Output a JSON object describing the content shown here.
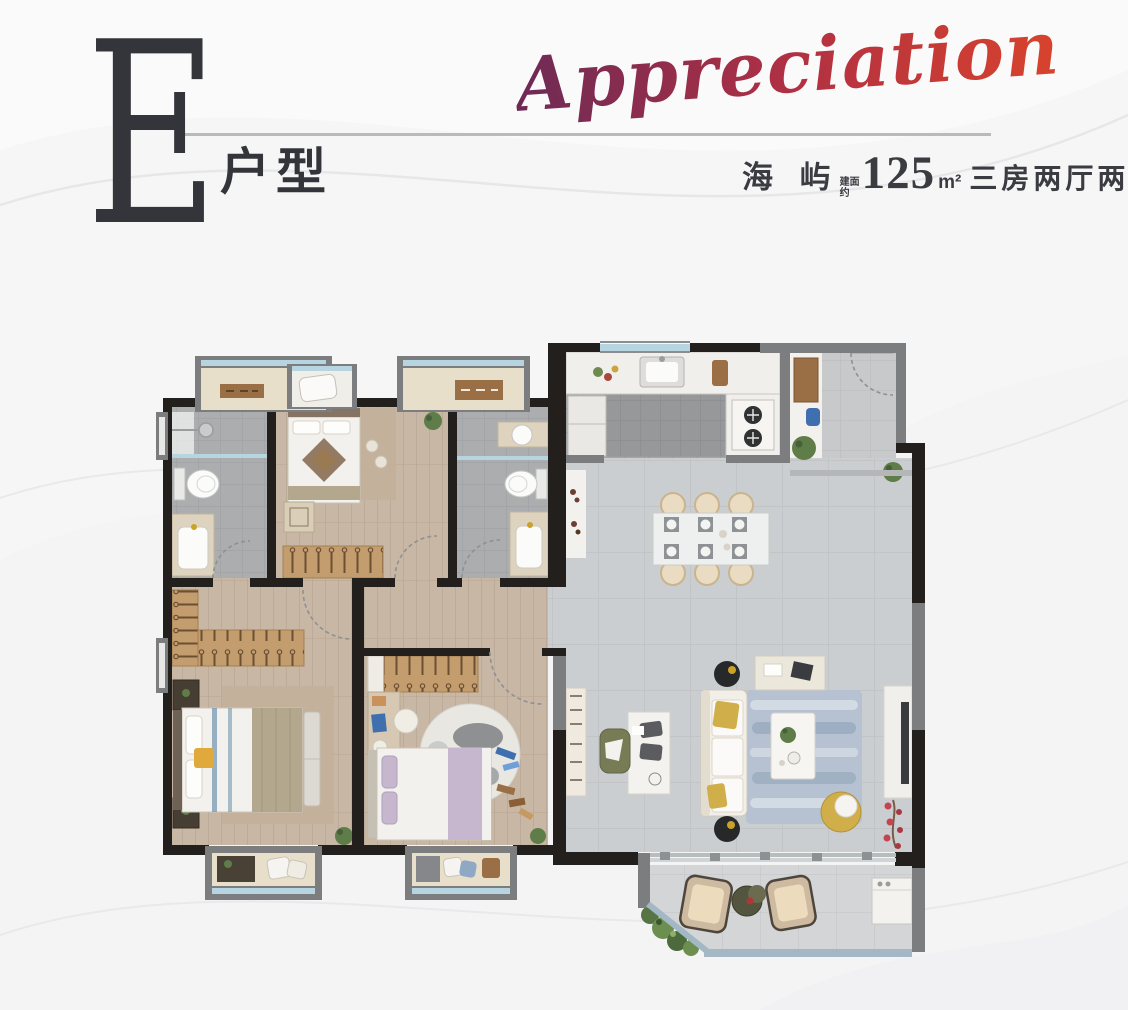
{
  "header": {
    "unit_letter": "E",
    "unit_label": "户型",
    "script_word": "Appreciation",
    "project_name": "海 屿",
    "area_prefix_line1": "建面",
    "area_prefix_line2": "约",
    "area_value": "125",
    "area_unit": "m²",
    "layout_summary": "三房两厅两卫",
    "text_color": "#34353b",
    "divider_color": "#b9babc"
  },
  "floor_plan": {
    "type": "residential-unit-plan",
    "palette": {
      "grad1": "#6d2a56",
      "grad2": "#b03043",
      "grad3": "#d8432c",
      "wall": "#221f1c",
      "wall_gray": "#7b7d7f",
      "wood": "#c8b7a4",
      "bath_tile": "#abadaf",
      "kitchen_tile": "#a4a6a8",
      "living_tile": "#cbced0",
      "balcony_tile": "#d3d5d6",
      "counter": "#f1efec",
      "glass": "#b7d5e1",
      "sill": "#e8dfcb",
      "wardrobe": "#c49d6e",
      "rug": "#c3b09a",
      "living_rug": "#b6c1d1",
      "cream": "#e9dcc2",
      "sofa": "#f2efe9",
      "accent_yellow": "#d0ae4a",
      "lavender": "#c6b6ce",
      "khaki": "#b3a88e",
      "plant_green": "#5f7d49",
      "wood_dark": "#9a6f45",
      "fixture_white": "#f4f2ef",
      "dark": "#3a3c40",
      "accent_blue": "#3f6fae",
      "railing": "#a3b8c4"
    }
  }
}
